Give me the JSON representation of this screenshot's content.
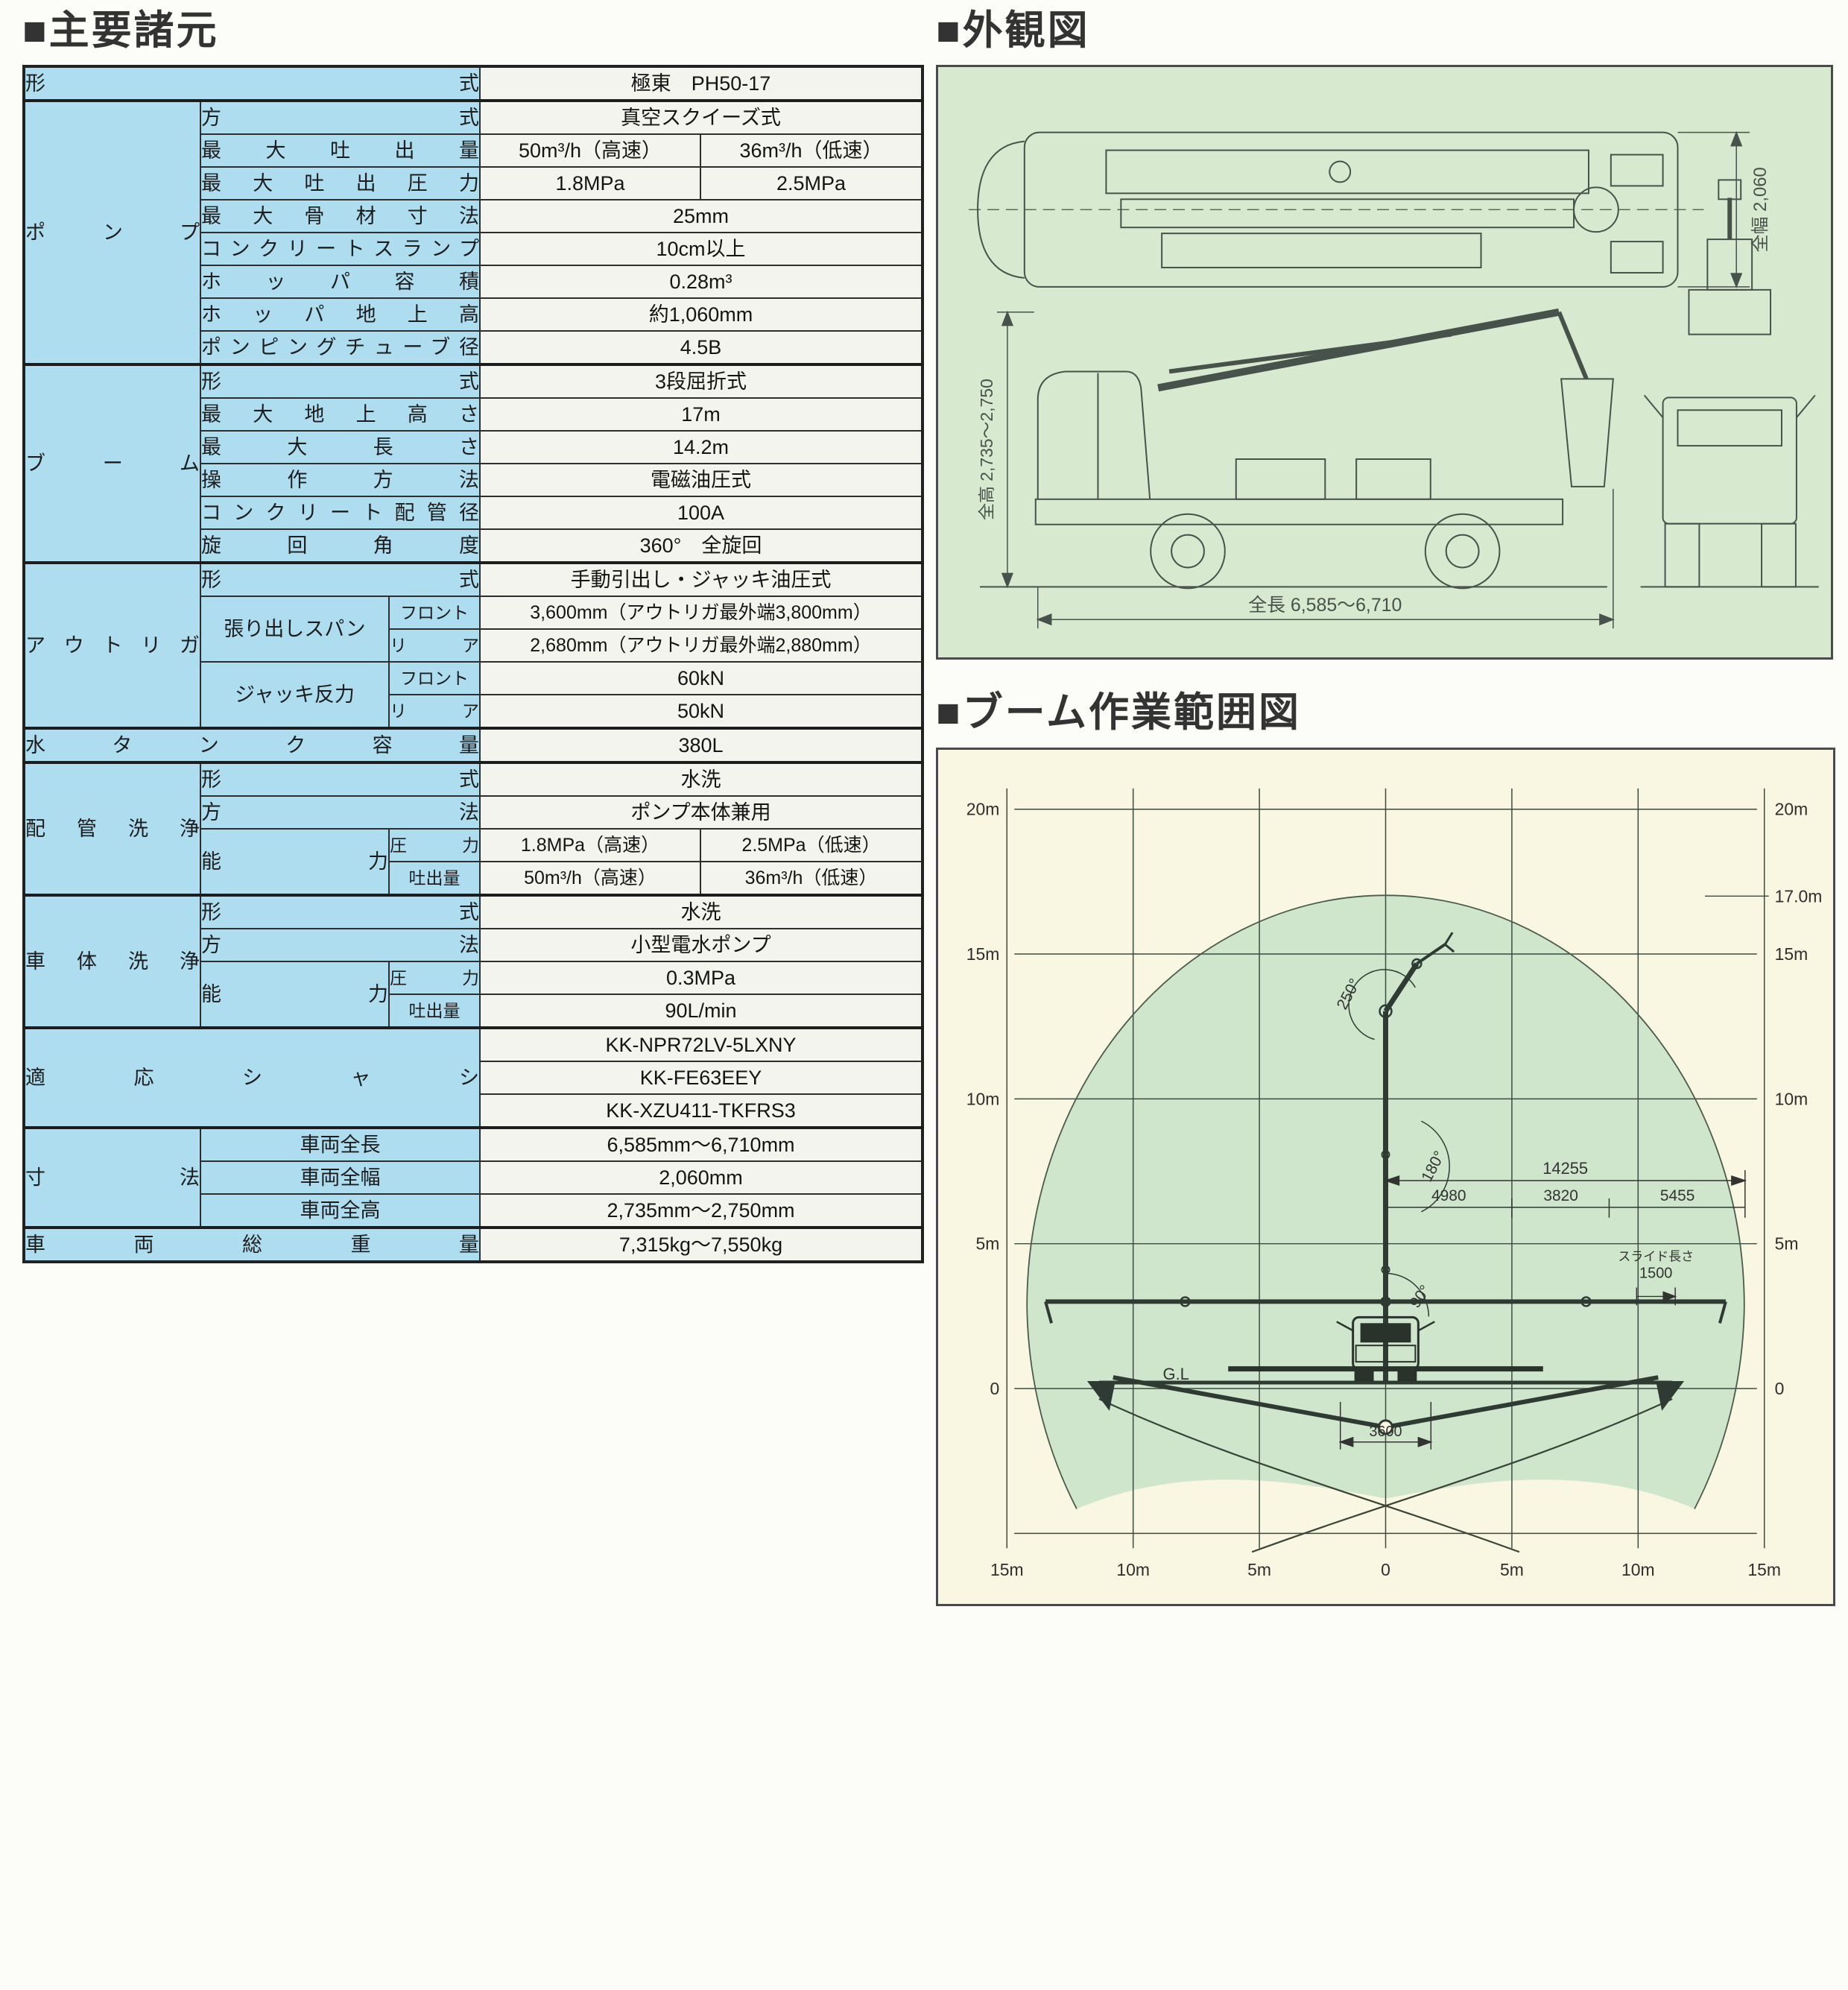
{
  "page": {
    "headings": {
      "specs": "■主要諸元",
      "exterior": "■外観図",
      "range": "■ブーム作業範囲図"
    }
  },
  "colors": {
    "table_header_bg": "#aeddf0",
    "table_value_bg": "#f4f4ee",
    "exterior_panel_bg": "#d7eacf",
    "range_panel_bg": "#f9f6e1",
    "envelope_fill": "#cfe6cc",
    "heading_text": "#333333",
    "line_art": "#47524c"
  },
  "spec_table": {
    "rows": [
      {
        "cells": [
          {
            "t": "形式",
            "k": "h",
            "c": 3,
            "sp": 1
          },
          {
            "t": "極東　PH50-17",
            "k": "v",
            "c": 2
          }
        ]
      },
      {
        "section": 1,
        "cells": [
          {
            "t": "ポンプ",
            "k": "h",
            "r": 8,
            "sp": 1
          },
          {
            "t": "方式",
            "k": "h",
            "c": 2,
            "sp": 1
          },
          {
            "t": "真空スクイーズ式",
            "k": "v",
            "c": 2
          }
        ]
      },
      {
        "cells": [
          {
            "t": "最大吐出量",
            "k": "h",
            "c": 2,
            "sp": 1
          },
          {
            "t": "50m³/h（高速）",
            "k": "v"
          },
          {
            "t": "36m³/h（低速）",
            "k": "v"
          }
        ]
      },
      {
        "cells": [
          {
            "t": "最大吐出圧力",
            "k": "h",
            "c": 2,
            "sp": 1
          },
          {
            "t": "1.8MPa",
            "k": "v"
          },
          {
            "t": "2.5MPa",
            "k": "v"
          }
        ]
      },
      {
        "cells": [
          {
            "t": "最大骨材寸法",
            "k": "h",
            "c": 2,
            "sp": 1
          },
          {
            "t": "25mm",
            "k": "v",
            "c": 2
          }
        ]
      },
      {
        "cells": [
          {
            "t": "コンクリートスランプ",
            "k": "h",
            "c": 2,
            "sp": 1
          },
          {
            "t": "10cm以上",
            "k": "v",
            "c": 2
          }
        ]
      },
      {
        "cells": [
          {
            "t": "ホッパ容積",
            "k": "h",
            "c": 2,
            "sp": 1
          },
          {
            "t": "0.28m³",
            "k": "v",
            "c": 2
          }
        ]
      },
      {
        "cells": [
          {
            "t": "ホッパ地上高",
            "k": "h",
            "c": 2,
            "sp": 1
          },
          {
            "t": "約1,060mm",
            "k": "v",
            "c": 2
          }
        ]
      },
      {
        "cells": [
          {
            "t": "ポンピングチューブ径",
            "k": "h",
            "c": 2,
            "sp": 1
          },
          {
            "t": "4.5B",
            "k": "v",
            "c": 2
          }
        ]
      },
      {
        "section": 1,
        "cells": [
          {
            "t": "ブーム",
            "k": "h",
            "r": 6,
            "sp": 1
          },
          {
            "t": "形式",
            "k": "h",
            "c": 2,
            "sp": 1
          },
          {
            "t": "3段屈折式",
            "k": "v",
            "c": 2
          }
        ]
      },
      {
        "cells": [
          {
            "t": "最大地上高さ",
            "k": "h",
            "c": 2,
            "sp": 1
          },
          {
            "t": "17m",
            "k": "v",
            "c": 2
          }
        ]
      },
      {
        "cells": [
          {
            "t": "最大長さ",
            "k": "h",
            "c": 2,
            "sp": 1
          },
          {
            "t": "14.2m",
            "k": "v",
            "c": 2
          }
        ]
      },
      {
        "cells": [
          {
            "t": "операция",
            "k": "h",
            "c": 2,
            "sp": 1,
            "alt": "操作方法",
            "use": "alt"
          },
          {
            "t": "電磁油圧式",
            "k": "v",
            "c": 2
          }
        ]
      },
      {
        "cells": [
          {
            "t": "コンクリート配管径",
            "k": "h",
            "c": 2,
            "sp": 1
          },
          {
            "t": "100A",
            "k": "v",
            "c": 2
          }
        ]
      },
      {
        "cells": [
          {
            "t": "旋回角度",
            "k": "h",
            "c": 2,
            "sp": 1
          },
          {
            "t": "360°　全旋回",
            "k": "v",
            "c": 2
          }
        ]
      },
      {
        "section": 1,
        "cells": [
          {
            "t": "アウトリガ",
            "k": "h",
            "r": 5,
            "sp": 1
          },
          {
            "t": "形式",
            "k": "h",
            "c": 2,
            "sp": 1
          },
          {
            "t": "手動引出し・ジャッキ油圧式",
            "k": "v",
            "c": 2
          }
        ]
      },
      {
        "cells": [
          {
            "t": "張り出しスパン",
            "k": "h",
            "r": 2
          },
          {
            "t": "フロント",
            "k": "h",
            "sm": 1
          },
          {
            "t": "3,600mm（アウトリガ最外端3,800mm）",
            "k": "v",
            "c": 2,
            "vl": 1
          }
        ]
      },
      {
        "cells": [
          {
            "t": "リア",
            "k": "h",
            "sm": 1,
            "sp": 1
          },
          {
            "t": "2,680mm（アウトリガ最外端2,880mm）",
            "k": "v",
            "c": 2,
            "vl": 1
          }
        ]
      },
      {
        "cells": [
          {
            "t": "ジャッキ反力",
            "k": "h",
            "r": 2
          },
          {
            "t": "フロント",
            "k": "h",
            "sm": 1
          },
          {
            "t": "60kN",
            "k": "v",
            "c": 2
          }
        ]
      },
      {
        "cells": [
          {
            "t": "リア",
            "k": "h",
            "sm": 1,
            "sp": 1
          },
          {
            "t": "50kN",
            "k": "v",
            "c": 2
          }
        ]
      },
      {
        "section": 1,
        "cells": [
          {
            "t": "水タンク容量",
            "k": "h",
            "c": 3,
            "sp": 1
          },
          {
            "t": "380L",
            "k": "v",
            "c": 2
          }
        ]
      },
      {
        "section": 1,
        "cells": [
          {
            "t": "配管洗浄",
            "k": "h",
            "r": 4,
            "sp": 1
          },
          {
            "t": "形式",
            "k": "h",
            "c": 2,
            "sp": 1
          },
          {
            "t": "水洗",
            "k": "v",
            "c": 2
          }
        ]
      },
      {
        "cells": [
          {
            "t": "方法",
            "k": "h",
            "c": 2,
            "sp": 1
          },
          {
            "t": "ポンプ本体兼用",
            "k": "v",
            "c": 2
          }
        ]
      },
      {
        "cells": [
          {
            "t": "能力",
            "k": "h",
            "r": 2,
            "sp": 1
          },
          {
            "t": "圧力",
            "k": "h",
            "sm": 1,
            "sp": 1
          },
          {
            "t": "1.8MPa（高速）",
            "k": "v",
            "vl": 1
          },
          {
            "t": "2.5MPa（低速）",
            "k": "v",
            "vl": 1
          }
        ]
      },
      {
        "cells": [
          {
            "t": "吐出量",
            "k": "h",
            "sm": 1
          },
          {
            "t": "50m³/h（高速）",
            "k": "v",
            "vl": 1
          },
          {
            "t": "36m³/h（低速）",
            "k": "v",
            "vl": 1
          }
        ]
      },
      {
        "section": 1,
        "cells": [
          {
            "t": "車体洗浄",
            "k": "h",
            "r": 4,
            "sp": 1
          },
          {
            "t": "形式",
            "k": "h",
            "c": 2,
            "sp": 1
          },
          {
            "t": "水洗",
            "k": "v",
            "c": 2
          }
        ]
      },
      {
        "cells": [
          {
            "t": "方法",
            "k": "h",
            "c": 2,
            "sp": 1
          },
          {
            "t": "小型電水ポンプ",
            "k": "v",
            "c": 2
          }
        ]
      },
      {
        "cells": [
          {
            "t": "能力",
            "k": "h",
            "r": 2,
            "sp": 1
          },
          {
            "t": "圧力",
            "k": "h",
            "sm": 1,
            "sp": 1
          },
          {
            "t": "0.3MPa",
            "k": "v",
            "c": 2
          }
        ]
      },
      {
        "cells": [
          {
            "t": "吐出量",
            "k": "h",
            "sm": 1
          },
          {
            "t": "90L/min",
            "k": "v",
            "c": 2
          }
        ]
      },
      {
        "section": 1,
        "cells": [
          {
            "t": "適応シャシ",
            "k": "h",
            "c": 3,
            "r": 3,
            "sp": 1
          },
          {
            "t": "KK-NPR72LV-5LXNY",
            "k": "v",
            "c": 2
          }
        ]
      },
      {
        "cells": [
          {
            "t": "KK-FE63EEY",
            "k": "v",
            "c": 2
          }
        ]
      },
      {
        "cells": [
          {
            "t": "KK-XZU411-TKFRS3",
            "k": "v",
            "c": 2
          }
        ]
      },
      {
        "section": 1,
        "cells": [
          {
            "t": "寸法",
            "k": "h",
            "r": 3,
            "sp": 1
          },
          {
            "t": "車両全長",
            "k": "h",
            "c": 2
          },
          {
            "t": "6,585mm～6,710mm",
            "k": "v",
            "c": 2
          }
        ]
      },
      {
        "cells": [
          {
            "t": "車両全幅",
            "k": "h",
            "c": 2
          },
          {
            "t": "2,060mm",
            "k": "v",
            "c": 2
          }
        ]
      },
      {
        "cells": [
          {
            "t": "車両全高",
            "k": "h",
            "c": 2
          },
          {
            "t": "2,735mm～2,750mm",
            "k": "v",
            "c": 2
          }
        ]
      },
      {
        "section": 1,
        "cells": [
          {
            "t": "車両総重量",
            "k": "h",
            "c": 3,
            "sp": 1
          },
          {
            "t": "7,315kg～7,550kg",
            "k": "v",
            "c": 2
          }
        ]
      }
    ]
  },
  "exterior": {
    "width_label": "全幅 2,060",
    "height_label": "全高 2,735～2,750",
    "length_label": "全長 6,585～6,710"
  },
  "range_chart": {
    "type": "diagram",
    "y_left": [
      "20m",
      "15m",
      "10m",
      "5m",
      "0"
    ],
    "y_right": [
      "20m",
      "17.0m",
      "15m",
      "10m",
      "5m",
      "0"
    ],
    "x_bottom": [
      "15m",
      "10m",
      "5m",
      "0",
      "5m",
      "10m",
      "15m"
    ],
    "angles": [
      "250°",
      "180°",
      "90°"
    ],
    "dims": {
      "total": "14255",
      "segments": [
        "4980",
        "3820",
        "5455"
      ],
      "slide_label": "スライド長さ",
      "slide_value": "1500",
      "outrigger_front": "3600",
      "ground": "G.L"
    },
    "max_height_m": 17.0,
    "max_reach_m": 14.2
  }
}
